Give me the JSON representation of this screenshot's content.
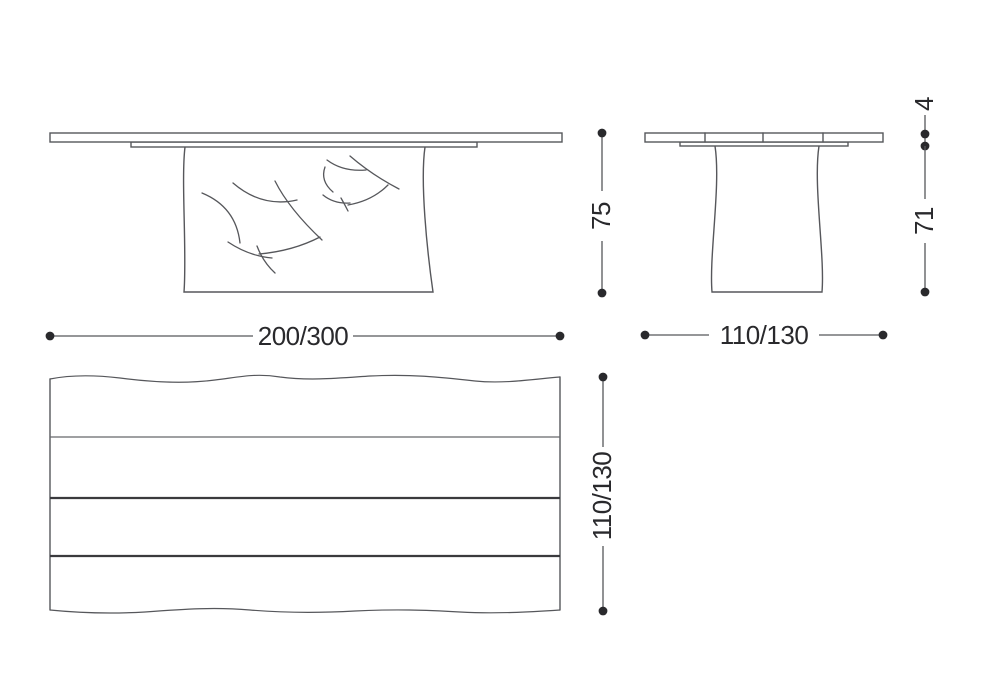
{
  "dimensions": {
    "front_width": "200/300",
    "side_depth": "110/130",
    "overall_height": "75",
    "base_height": "71",
    "top_thickness": "4",
    "plan_depth": "110/130"
  },
  "colors": {
    "line": "#56575b",
    "ink": "#29292c",
    "soft": "#66676b",
    "dark": "#3a3a3d",
    "bg": "#ffffff"
  }
}
